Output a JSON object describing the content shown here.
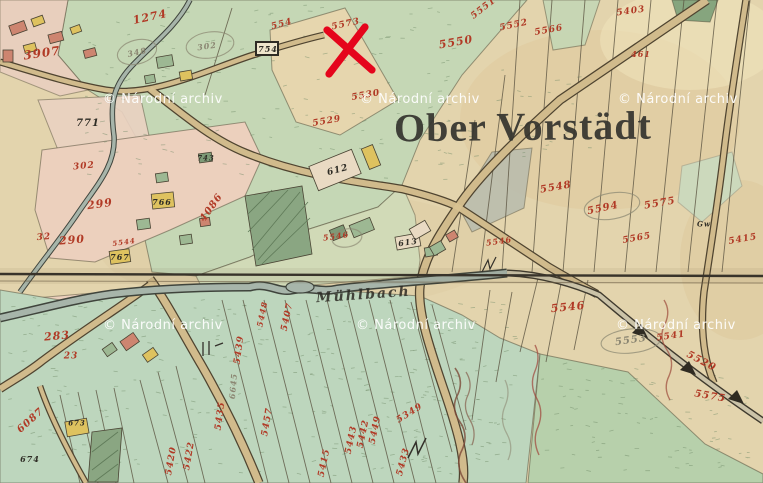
{
  "map": {
    "region_label": "Ober Vorstädt",
    "stream_label": "Mühlbach",
    "watermark_text": "© Národní archiv",
    "watermark_positions": [
      {
        "x": 103,
        "y": 92
      },
      {
        "x": 360,
        "y": 92
      },
      {
        "x": 618,
        "y": 92
      },
      {
        "x": 103,
        "y": 318
      },
      {
        "x": 356,
        "y": 318
      },
      {
        "x": 616,
        "y": 318
      }
    ],
    "marker": {
      "shape": "red-x",
      "x": 349,
      "y": 50
    },
    "colors": {
      "parchment": "#e3d4ad",
      "field_green": "#c5d7b5",
      "meadow_green": "#bdd6bd",
      "parcel_pink": "#ecd0bd",
      "building_yellow": "#dec25f",
      "building_red": "#cd8570",
      "building_green": "#9db893",
      "woods_green": "#8aa682",
      "road_tan": "#d8c291",
      "road_edge": "#4f4430",
      "stream_gray": "#a7b5aa",
      "number_red": "#b13a26",
      "ink_black": "#2e2c25",
      "pencil_gray": "#8b8672",
      "x_red": "#e5051c"
    },
    "parcel_labels": [
      {
        "text": "1274",
        "x": 150,
        "y": 17,
        "rot": -12,
        "c": "r",
        "s": 11
      },
      {
        "text": "554",
        "x": 282,
        "y": 25,
        "rot": -15,
        "c": "r",
        "s": 9
      },
      {
        "text": "5573",
        "x": 346,
        "y": 25,
        "rot": -12,
        "c": "r",
        "s": 9
      },
      {
        "text": "5550",
        "x": 456,
        "y": 42,
        "rot": -10,
        "c": "r",
        "s": 11
      },
      {
        "text": "5551",
        "x": 484,
        "y": 9,
        "rot": -38,
        "c": "r",
        "s": 9
      },
      {
        "text": "5552",
        "x": 514,
        "y": 26,
        "rot": -12,
        "c": "r",
        "s": 9
      },
      {
        "text": "5566",
        "x": 549,
        "y": 31,
        "rot": -10,
        "c": "r",
        "s": 9
      },
      {
        "text": "5403",
        "x": 631,
        "y": 12,
        "rot": -8,
        "c": "r",
        "s": 9
      },
      {
        "text": "461",
        "x": 641,
        "y": 54,
        "rot": 0,
        "c": "r",
        "s": 8
      },
      {
        "text": "3907",
        "x": 42,
        "y": 53,
        "rot": -8,
        "c": "r",
        "s": 12
      },
      {
        "text": "302",
        "x": 207,
        "y": 46,
        "rot": -8,
        "c": "p",
        "s": 8
      },
      {
        "text": "348",
        "x": 137,
        "y": 52,
        "rot": -12,
        "c": "p",
        "s": 8
      },
      {
        "text": "754",
        "x": 268,
        "y": 49,
        "rot": 0,
        "c": "k",
        "s": 8
      },
      {
        "text": "771",
        "x": 88,
        "y": 124,
        "rot": 0,
        "c": "k",
        "s": 10
      },
      {
        "text": "302",
        "x": 84,
        "y": 167,
        "rot": -5,
        "c": "r",
        "s": 9
      },
      {
        "text": "299",
        "x": 100,
        "y": 204,
        "rot": -8,
        "c": "r",
        "s": 11
      },
      {
        "text": "32",
        "x": 44,
        "y": 238,
        "rot": -5,
        "c": "r",
        "s": 9
      },
      {
        "text": "290",
        "x": 72,
        "y": 240,
        "rot": -5,
        "c": "r",
        "s": 11
      },
      {
        "text": "5544",
        "x": 124,
        "y": 242,
        "rot": -8,
        "c": "r",
        "s": 7
      },
      {
        "text": "283",
        "x": 57,
        "y": 336,
        "rot": -5,
        "c": "r",
        "s": 11
      },
      {
        "text": "23",
        "x": 71,
        "y": 357,
        "rot": 0,
        "c": "r",
        "s": 9
      },
      {
        "text": "766",
        "x": 162,
        "y": 202,
        "rot": 0,
        "c": "k",
        "s": 8
      },
      {
        "text": "767",
        "x": 120,
        "y": 257,
        "rot": 0,
        "c": "k",
        "s": 8
      },
      {
        "text": "743",
        "x": 206,
        "y": 158,
        "rot": 0,
        "c": "k",
        "s": 7
      },
      {
        "text": "4086",
        "x": 212,
        "y": 208,
        "rot": -55,
        "c": "r",
        "s": 10
      },
      {
        "text": "612",
        "x": 338,
        "y": 171,
        "rot": -15,
        "c": "k",
        "s": 9
      },
      {
        "text": "613",
        "x": 408,
        "y": 242,
        "rot": -8,
        "c": "k",
        "s": 8
      },
      {
        "text": "5546",
        "x": 336,
        "y": 236,
        "rot": -8,
        "c": "r",
        "s": 8
      },
      {
        "text": "5530",
        "x": 366,
        "y": 96,
        "rot": -10,
        "c": "r",
        "s": 9
      },
      {
        "text": "5529",
        "x": 327,
        "y": 122,
        "rot": -10,
        "c": "r",
        "s": 9
      },
      {
        "text": "5548",
        "x": 556,
        "y": 188,
        "rot": -10,
        "c": "r",
        "s": 10
      },
      {
        "text": "5594",
        "x": 603,
        "y": 209,
        "rot": -12,
        "c": "r",
        "s": 10
      },
      {
        "text": "5575",
        "x": 660,
        "y": 204,
        "rot": -10,
        "c": "r",
        "s": 10
      },
      {
        "text": "5565",
        "x": 637,
        "y": 239,
        "rot": -10,
        "c": "r",
        "s": 9
      },
      {
        "text": "5415",
        "x": 743,
        "y": 240,
        "rot": -10,
        "c": "r",
        "s": 9
      },
      {
        "text": "5546",
        "x": 499,
        "y": 241,
        "rot": -8,
        "c": "r",
        "s": 8
      },
      {
        "text": "Gw",
        "x": 704,
        "y": 224,
        "rot": 0,
        "c": "k",
        "s": 7
      },
      {
        "text": "5407",
        "x": 288,
        "y": 317,
        "rot": -78,
        "c": "r",
        "s": 9
      },
      {
        "text": "5448",
        "x": 262,
        "y": 314,
        "rot": -78,
        "c": "r",
        "s": 8
      },
      {
        "text": "6087",
        "x": 31,
        "y": 421,
        "rot": -42,
        "c": "r",
        "s": 10
      },
      {
        "text": "674",
        "x": 30,
        "y": 459,
        "rot": 0,
        "c": "k",
        "s": 8
      },
      {
        "text": "673",
        "x": 77,
        "y": 423,
        "rot": 0,
        "c": "k",
        "s": 7
      },
      {
        "text": "5439",
        "x": 240,
        "y": 350,
        "rot": -82,
        "c": "r",
        "s": 9
      },
      {
        "text": "6645",
        "x": 233,
        "y": 386,
        "rot": -85,
        "c": "p",
        "s": 8
      },
      {
        "text": "5435",
        "x": 221,
        "y": 416,
        "rot": -82,
        "c": "r",
        "s": 9
      },
      {
        "text": "5422",
        "x": 190,
        "y": 456,
        "rot": -80,
        "c": "r",
        "s": 9
      },
      {
        "text": "5420",
        "x": 172,
        "y": 461,
        "rot": -80,
        "c": "r",
        "s": 9
      },
      {
        "text": "5457",
        "x": 268,
        "y": 422,
        "rot": -80,
        "c": "r",
        "s": 9
      },
      {
        "text": "5415",
        "x": 325,
        "y": 463,
        "rot": -78,
        "c": "r",
        "s": 9
      },
      {
        "text": "5443",
        "x": 352,
        "y": 440,
        "rot": -78,
        "c": "r",
        "s": 9
      },
      {
        "text": "5442",
        "x": 364,
        "y": 434,
        "rot": -78,
        "c": "r",
        "s": 9
      },
      {
        "text": "5449",
        "x": 376,
        "y": 430,
        "rot": -78,
        "c": "r",
        "s": 9
      },
      {
        "text": "5433",
        "x": 404,
        "y": 462,
        "rot": -75,
        "c": "r",
        "s": 9
      },
      {
        "text": "5349",
        "x": 410,
        "y": 414,
        "rot": -32,
        "c": "r",
        "s": 9
      },
      {
        "text": "5546",
        "x": 568,
        "y": 307,
        "rot": -6,
        "c": "r",
        "s": 11
      },
      {
        "text": "5553",
        "x": 631,
        "y": 341,
        "rot": -8,
        "c": "p",
        "s": 10
      },
      {
        "text": "5541",
        "x": 671,
        "y": 337,
        "rot": -8,
        "c": "r",
        "s": 9
      },
      {
        "text": "5520",
        "x": 701,
        "y": 362,
        "rot": 28,
        "c": "r",
        "s": 10
      },
      {
        "text": "5575",
        "x": 710,
        "y": 397,
        "rot": 10,
        "c": "r",
        "s": 10
      }
    ]
  }
}
